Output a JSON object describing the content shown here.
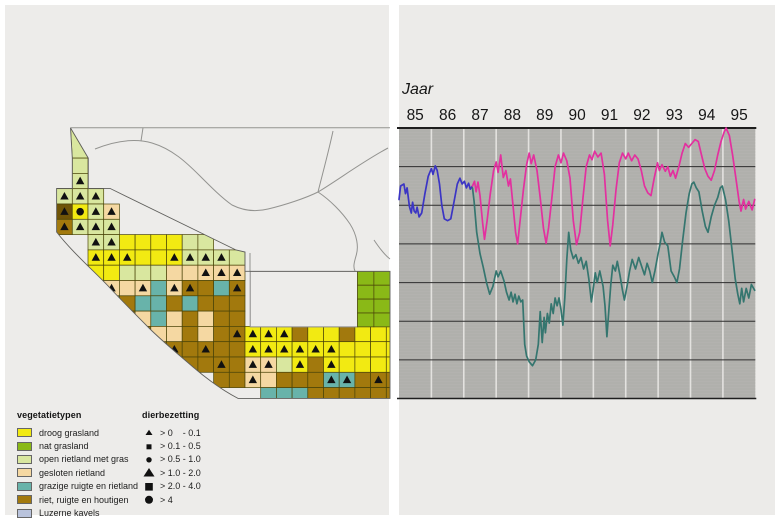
{
  "map": {
    "legend_vegetation": {
      "title": "vegetatietypen",
      "items": [
        {
          "label": "droog grasland",
          "color": "#f2ea12"
        },
        {
          "label": "nat grasland",
          "color": "#8ab917"
        },
        {
          "label": "open rietland met gras",
          "color": "#d9e79f"
        },
        {
          "label": "gesloten rietland",
          "color": "#f5d8a2"
        },
        {
          "label": "grazige ruigte en rietland",
          "color": "#68b3aa"
        },
        {
          "label": "riet, ruigte en houtigen",
          "color": "#a2790d"
        },
        {
          "label": "Luzerne kavels",
          "color": "#b9c3dc"
        }
      ]
    },
    "legend_density": {
      "title": "dierbezetting",
      "items": [
        {
          "label": "> 0    - 0.1",
          "symbol": "triangle-small"
        },
        {
          "label": "> 0.1 - 0.5",
          "symbol": "square-small"
        },
        {
          "label": "> 0.5 - 1.0",
          "symbol": "circle-small"
        },
        {
          "label": "> 1.0 - 2.0",
          "symbol": "triangle-large"
        },
        {
          "label": "> 2.0 - 4.0",
          "symbol": "square-large"
        },
        {
          "label": "> 4",
          "symbol": "circle-large"
        }
      ]
    },
    "colors": {
      "Y": "#f2ea12",
      "G": "#8ab917",
      "O": "#d9e79f",
      "T": "#f5d8a2",
      "Z": "#68b3aa",
      "B": "#a2790d",
      "D": "#6f5407",
      "L": "#b9c3dc"
    },
    "cells": [
      "1,2,O",
      "1,3,O,t",
      "0,4,O,t",
      "1,4,O,t",
      "2,4,O,t",
      "0,5,D,t",
      "1,5,Y,C",
      "2,5,O,t",
      "3,5,T,t",
      "0,6,B,t",
      "1,6,O,t",
      "2,6,O,t",
      "3,6,O,t",
      "2,7,O,t",
      "3,7,O,t",
      "4,7,Y",
      "5,7,Y",
      "6,7,Y",
      "7,7,Y",
      "8,7,O",
      "9,7,O",
      "2,8,Y,t",
      "3,8,Y,t",
      "4,8,Y,t",
      "5,8,Y",
      "6,8,Y",
      "7,8,Y,t",
      "8,8,O,t",
      "9,8,O,t",
      "10,8,O,t",
      "11,8,O",
      "2,9,Y",
      "3,9,Y",
      "4,9,O",
      "5,9,O",
      "6,9,O",
      "7,9,T",
      "8,9,T",
      "9,9,T,t",
      "10,9,T,t",
      "11,9,T,t",
      "3,10,T,t",
      "4,10,T",
      "5,10,T,t",
      "6,10,Z",
      "7,10,T,t",
      "8,10,B,t",
      "9,10,B",
      "10,10,Z",
      "11,10,B,t",
      "3,11,Z,t",
      "4,11,B",
      "5,11,Z",
      "6,11,Z",
      "7,11,B",
      "8,11,Z",
      "9,11,B",
      "10,11,B",
      "11,11,B",
      "4,12,B,t",
      "5,12,T",
      "6,12,Z",
      "7,12,T",
      "8,12,B",
      "9,12,T",
      "10,12,B",
      "11,12,B",
      "5,13,B,t",
      "6,13,T",
      "7,13,T",
      "8,13,B",
      "9,13,T",
      "10,13,B",
      "11,13,B,t",
      "12,13,Y,t",
      "13,13,Y,t",
      "14,13,Y,t",
      "15,13,B",
      "16,13,Y",
      "17,13,Y",
      "18,13,B",
      "19,13,Y",
      "20,13,Y",
      "21,13,Y",
      "6,14,B",
      "7,14,B,t",
      "8,14,B",
      "9,14,B,t",
      "10,14,B",
      "11,14,B",
      "12,14,Y,t",
      "13,14,Y,t",
      "14,14,Y,t",
      "15,14,Y,t",
      "16,14,Y,t",
      "17,14,Y,t",
      "18,14,Y",
      "19,14,Y",
      "20,14,Y",
      "21,14,Y",
      "8,15,B",
      "9,15,B",
      "10,15,B,t",
      "11,15,B",
      "12,15,T,t",
      "13,15,T,t",
      "14,15,O",
      "15,15,Y,t",
      "16,15,B",
      "17,15,Y,t",
      "18,15,Y",
      "19,15,Y",
      "20,15,Y",
      "21,15,Y",
      "10,16,B",
      "11,16,B",
      "12,16,T,t",
      "13,16,T",
      "14,16,B",
      "15,16,B",
      "16,16,B",
      "17,16,Z,t",
      "18,16,Z,t",
      "19,16,B",
      "20,16,B,t",
      "21,16,B",
      "13,17,Z",
      "14,17,Z",
      "15,17,Z",
      "16,17,B",
      "17,17,B",
      "18,17,B",
      "19,17,B",
      "20,17,B",
      "21,17,B"
    ]
  },
  "chart_data": {
    "type": "line",
    "title": "Jaar",
    "x_tick_labels": [
      "85",
      "86",
      "87",
      "88",
      "89",
      "90",
      "91",
      "92",
      "93",
      "94",
      "95"
    ],
    "x_range": [
      1985,
      1996
    ],
    "y_axis": {
      "labels_visible": false,
      "range": [
        0,
        7
      ],
      "gridline_levels": [
        1,
        2,
        3,
        4,
        5,
        6
      ]
    },
    "legend_position": "none",
    "grid": {
      "vertical": "white-year-boundaries",
      "horizontal": "dark-lines"
    },
    "series": [
      {
        "name": "line-blue",
        "color": "#3b35c4",
        "points": [
          [
            85.0,
            5.15
          ],
          [
            85.05,
            5.5
          ],
          [
            85.15,
            5.55
          ],
          [
            85.2,
            5.3
          ],
          [
            85.25,
            5.45
          ],
          [
            85.32,
            4.97
          ],
          [
            85.38,
            4.8
          ],
          [
            85.42,
            5.08
          ],
          [
            85.47,
            4.85
          ],
          [
            85.52,
            4.8
          ],
          [
            85.56,
            4.95
          ],
          [
            85.62,
            4.7
          ],
          [
            85.7,
            4.8
          ],
          [
            85.8,
            5.3
          ],
          [
            85.9,
            5.75
          ],
          [
            86.0,
            5.95
          ],
          [
            86.05,
            5.8
          ],
          [
            86.12,
            6.02
          ],
          [
            86.18,
            5.9
          ],
          [
            86.25,
            5.55
          ],
          [
            86.32,
            5.0
          ],
          [
            86.4,
            4.65
          ],
          [
            86.5,
            4.6
          ],
          [
            86.6,
            4.65
          ],
          [
            86.7,
            5.1
          ],
          [
            86.8,
            5.55
          ],
          [
            86.88,
            5.7
          ],
          [
            86.95,
            5.55
          ],
          [
            87.02,
            5.62
          ],
          [
            87.08,
            5.45
          ],
          [
            87.15,
            5.57
          ],
          [
            87.2,
            5.42
          ],
          [
            87.27,
            5.5
          ]
        ]
      },
      {
        "name": "line-magenta",
        "color": "#e3309f",
        "points": [
          [
            87.27,
            5.5
          ],
          [
            87.33,
            5.62
          ],
          [
            87.38,
            5.35
          ],
          [
            87.44,
            5.6
          ],
          [
            87.5,
            5.25
          ],
          [
            87.58,
            4.55
          ],
          [
            87.64,
            4.12
          ],
          [
            87.72,
            4.6
          ],
          [
            87.82,
            5.3
          ],
          [
            87.92,
            5.9
          ],
          [
            88.0,
            6.12
          ],
          [
            88.06,
            5.85
          ],
          [
            88.14,
            6.3
          ],
          [
            88.22,
            5.72
          ],
          [
            88.3,
            5.9
          ],
          [
            88.38,
            5.5
          ],
          [
            88.44,
            5.68
          ],
          [
            88.52,
            5.0
          ],
          [
            88.6,
            4.3
          ],
          [
            88.66,
            4.0
          ],
          [
            88.74,
            4.6
          ],
          [
            88.84,
            5.4
          ],
          [
            88.94,
            6.05
          ],
          [
            89.02,
            6.35
          ],
          [
            89.08,
            6.08
          ],
          [
            89.16,
            6.3
          ],
          [
            89.26,
            5.9
          ],
          [
            89.36,
            5.2
          ],
          [
            89.46,
            4.4
          ],
          [
            89.54,
            4.02
          ],
          [
            89.62,
            4.42
          ],
          [
            89.72,
            5.2
          ],
          [
            89.82,
            6.0
          ],
          [
            89.92,
            6.3
          ],
          [
            90.0,
            6.1
          ],
          [
            90.08,
            6.35
          ],
          [
            90.18,
            6.15
          ],
          [
            90.28,
            5.7
          ],
          [
            90.38,
            4.6
          ],
          [
            90.48,
            3.98
          ],
          [
            90.58,
            4.3
          ],
          [
            90.68,
            5.2
          ],
          [
            90.78,
            6.0
          ],
          [
            90.88,
            6.3
          ],
          [
            90.96,
            6.18
          ],
          [
            91.04,
            6.4
          ],
          [
            91.14,
            6.25
          ],
          [
            91.24,
            6.35
          ],
          [
            91.34,
            5.8
          ],
          [
            91.44,
            4.6
          ],
          [
            91.52,
            3.95
          ],
          [
            91.6,
            4.5
          ],
          [
            91.7,
            5.4
          ],
          [
            91.8,
            6.1
          ],
          [
            91.9,
            6.35
          ],
          [
            92.0,
            6.2
          ],
          [
            92.08,
            6.35
          ],
          [
            92.18,
            6.15
          ],
          [
            92.28,
            6.3
          ],
          [
            92.38,
            6.2
          ],
          [
            92.48,
            5.9
          ],
          [
            92.58,
            5.5
          ],
          [
            92.68,
            5.32
          ],
          [
            92.78,
            5.25
          ],
          [
            92.88,
            5.7
          ],
          [
            92.98,
            6.1
          ],
          [
            93.04,
            5.9
          ],
          [
            93.12,
            6.05
          ],
          [
            93.22,
            5.88
          ],
          [
            93.3,
            6.0
          ],
          [
            93.38,
            5.75
          ],
          [
            93.46,
            5.9
          ],
          [
            93.54,
            5.7
          ],
          [
            93.64,
            6.0
          ],
          [
            93.74,
            6.35
          ],
          [
            93.84,
            6.6
          ],
          [
            93.94,
            6.5
          ],
          [
            94.04,
            6.6
          ],
          [
            94.14,
            6.7
          ],
          [
            94.24,
            6.65
          ],
          [
            94.34,
            6.3
          ],
          [
            94.44,
            5.95
          ],
          [
            94.54,
            5.75
          ],
          [
            94.64,
            5.65
          ],
          [
            94.74,
            5.9
          ],
          [
            94.84,
            6.3
          ],
          [
            94.94,
            6.65
          ],
          [
            95.04,
            6.9
          ],
          [
            95.1,
            7.0
          ],
          [
            95.2,
            6.8
          ],
          [
            95.3,
            6.3
          ],
          [
            95.4,
            5.7
          ],
          [
            95.5,
            5.1
          ],
          [
            95.56,
            4.85
          ],
          [
            95.64,
            5.15
          ],
          [
            95.7,
            4.9
          ],
          [
            95.8,
            5.1
          ],
          [
            95.9,
            4.88
          ],
          [
            95.98,
            5.15
          ]
        ]
      },
      {
        "name": "line-teal",
        "color": "#35766f",
        "points": [
          [
            87.27,
            5.45
          ],
          [
            87.32,
            5.1
          ],
          [
            87.4,
            4.3
          ],
          [
            87.5,
            3.75
          ],
          [
            87.6,
            3.4
          ],
          [
            87.7,
            3.0
          ],
          [
            87.8,
            2.7
          ],
          [
            87.9,
            2.9
          ],
          [
            88.0,
            3.3
          ],
          [
            88.06,
            3.15
          ],
          [
            88.14,
            3.3
          ],
          [
            88.24,
            3.05
          ],
          [
            88.32,
            2.75
          ],
          [
            88.4,
            2.55
          ],
          [
            88.46,
            2.75
          ],
          [
            88.52,
            2.5
          ],
          [
            88.58,
            2.7
          ],
          [
            88.64,
            2.45
          ],
          [
            88.7,
            2.65
          ],
          [
            88.76,
            2.5
          ],
          [
            88.82,
            2.55
          ],
          [
            88.88,
            1.4
          ],
          [
            88.94,
            1.1
          ],
          [
            89.02,
            0.95
          ],
          [
            89.12,
            0.85
          ],
          [
            89.22,
            1.0
          ],
          [
            89.3,
            1.4
          ],
          [
            89.36,
            2.25
          ],
          [
            89.42,
            1.45
          ],
          [
            89.48,
            2.1
          ],
          [
            89.52,
            1.7
          ],
          [
            89.58,
            2.2
          ],
          [
            89.64,
            1.95
          ],
          [
            89.7,
            2.45
          ],
          [
            89.76,
            2.2
          ],
          [
            89.82,
            2.6
          ],
          [
            89.88,
            2.4
          ],
          [
            89.94,
            2.6
          ],
          [
            90.0,
            2.3
          ],
          [
            90.06,
            1.9
          ],
          [
            90.12,
            2.6
          ],
          [
            90.18,
            3.6
          ],
          [
            90.24,
            4.3
          ],
          [
            90.3,
            3.85
          ],
          [
            90.38,
            3.62
          ],
          [
            90.46,
            3.72
          ],
          [
            90.54,
            3.5
          ],
          [
            90.62,
            3.65
          ],
          [
            90.7,
            3.35
          ],
          [
            90.78,
            3.55
          ],
          [
            90.86,
            3.1
          ],
          [
            90.94,
            2.5
          ],
          [
            91.0,
            2.85
          ],
          [
            91.06,
            3.25
          ],
          [
            91.12,
            3.0
          ],
          [
            91.2,
            3.3
          ],
          [
            91.3,
            2.9
          ],
          [
            91.36,
            2.4
          ],
          [
            91.42,
            1.6
          ],
          [
            91.48,
            2.3
          ],
          [
            91.54,
            2.95
          ],
          [
            91.6,
            3.45
          ],
          [
            91.68,
            3.3
          ],
          [
            91.74,
            3.55
          ],
          [
            91.82,
            3.2
          ],
          [
            91.9,
            2.8
          ],
          [
            91.96,
            2.55
          ],
          [
            92.04,
            2.9
          ],
          [
            92.12,
            3.3
          ],
          [
            92.2,
            3.6
          ],
          [
            92.3,
            3.35
          ],
          [
            92.4,
            3.65
          ],
          [
            92.5,
            3.4
          ],
          [
            92.58,
            3.2
          ],
          [
            92.66,
            3.5
          ],
          [
            92.74,
            3.3
          ],
          [
            92.82,
            3.0
          ],
          [
            92.9,
            3.3
          ],
          [
            93.0,
            3.75
          ],
          [
            93.06,
            4.0
          ],
          [
            93.12,
            4.3
          ],
          [
            93.2,
            4.05
          ],
          [
            93.3,
            3.95
          ],
          [
            93.4,
            3.3
          ],
          [
            93.5,
            3.15
          ],
          [
            93.58,
            3.0
          ],
          [
            93.66,
            3.35
          ],
          [
            93.76,
            4.1
          ],
          [
            93.86,
            4.8
          ],
          [
            93.96,
            5.3
          ],
          [
            94.04,
            5.55
          ],
          [
            94.1,
            5.6
          ],
          [
            94.18,
            5.45
          ],
          [
            94.26,
            5.35
          ],
          [
            94.36,
            4.85
          ],
          [
            94.46,
            4.45
          ],
          [
            94.54,
            4.3
          ],
          [
            94.64,
            4.7
          ],
          [
            94.74,
            5.0
          ],
          [
            94.84,
            5.2
          ],
          [
            94.92,
            5.45
          ],
          [
            94.98,
            5.5
          ],
          [
            95.08,
            5.15
          ],
          [
            95.18,
            4.6
          ],
          [
            95.28,
            3.85
          ],
          [
            95.38,
            3.1
          ],
          [
            95.46,
            2.7
          ],
          [
            95.52,
            2.45
          ],
          [
            95.58,
            2.85
          ],
          [
            95.64,
            2.5
          ],
          [
            95.72,
            2.85
          ],
          [
            95.8,
            2.6
          ],
          [
            95.88,
            2.95
          ],
          [
            95.98,
            2.8
          ]
        ]
      }
    ]
  }
}
